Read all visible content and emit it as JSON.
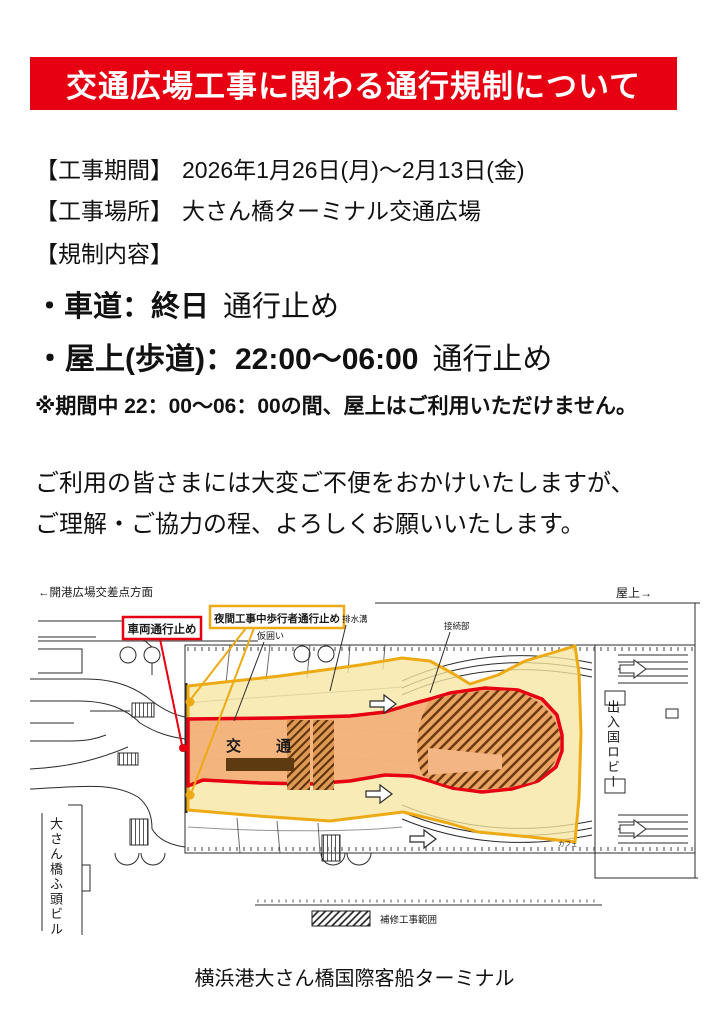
{
  "title": {
    "text": "交通広場工事に関わる通行規制について",
    "bg_color": "#e60012",
    "text_color": "#ffffff"
  },
  "info": {
    "period_label": "【工事期間】",
    "period_value": "2026年1月26日(月)～2月13日(金)",
    "place_label": "【工事場所】",
    "place_value": "大さん橋ターミナル交通広場",
    "content_label": "【規制内容】"
  },
  "restrictions": {
    "road_head": "・車道：終日",
    "road_tail": "通行止め",
    "roof_head": "・屋上(歩道)：22:00～06:00",
    "roof_tail": "通行止め",
    "note": "※期間中 22：00～06：00の間、屋上はご利用いただけません。"
  },
  "apology": {
    "line1": "ご利用の皆さまには大変ご不便をおかけいたしますが、",
    "line2": "ご理解・ご協力の程、よろしくお願いいたします。"
  },
  "map": {
    "direction_left": "←開港広場交差点方面",
    "direction_right": "屋上→",
    "callout_vehicle": "車両通行止め",
    "callout_night": "夜間工事中歩行者通行止め",
    "label_kakoi": "仮囲い",
    "label_drain": "排水溝",
    "label_setsuzoku": "接続部",
    "label_lobby": "出入国ロビー",
    "label_building": "大さん橋ふ頭ビル",
    "label_cafe": "カフェ",
    "label_plaza": "交　通",
    "legend_label": "補修工事範囲",
    "colors": {
      "restricted_red": "#e60012",
      "night_zone_fill": "#f6e6a2",
      "night_zone_border": "#edaa14",
      "vehicle_zone_fill": "#f2ae78"
    }
  },
  "footer": {
    "text": "横浜港大さん橋国際客船ターミナル"
  }
}
